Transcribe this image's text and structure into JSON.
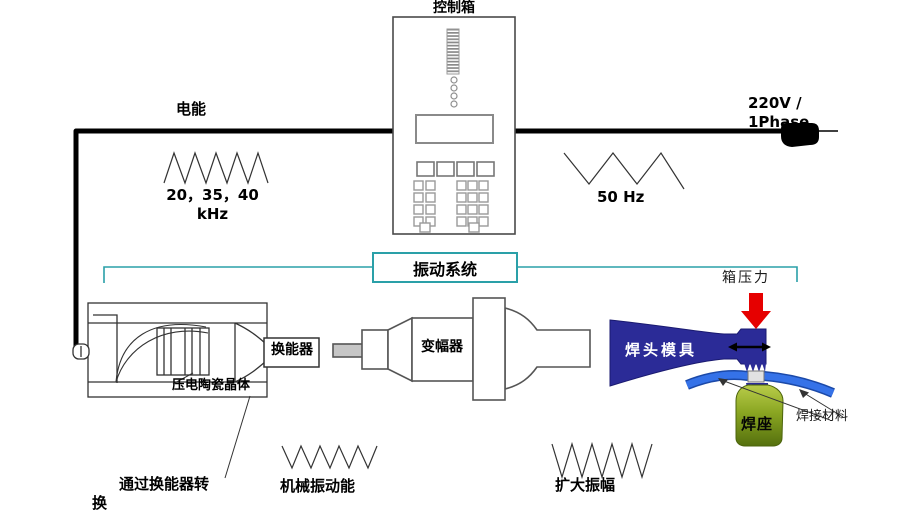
{
  "colors": {
    "teal_accent": "#2aa0a8",
    "horn_navy": "#2b2b97",
    "strip_blue": "#3572e8",
    "anvil_green": "#7d9a1d",
    "arrow_red": "#e60000"
  },
  "top": {
    "control_box_label": "控制箱",
    "electric_energy_label": "电能",
    "generator_freq_label": "20，35，40\nkHz",
    "power_label": "220V /\n1Phase",
    "mains_freq_label": "50 Hz"
  },
  "system": {
    "vibration_system_label": "振动系统",
    "transducer_label": "换能器",
    "piezo_label": "压电陶瓷晶体",
    "booster_label": "变幅器",
    "horn_label": "焊头模具",
    "pressure_label": "箱压力",
    "anvil_label": "焊座",
    "weld_material_label": "焊接材料"
  },
  "bottom": {
    "convert_label": "通过换能器转\n换",
    "mech_vibration_label": "机械振动能",
    "amplify_label": "扩大振幅"
  }
}
